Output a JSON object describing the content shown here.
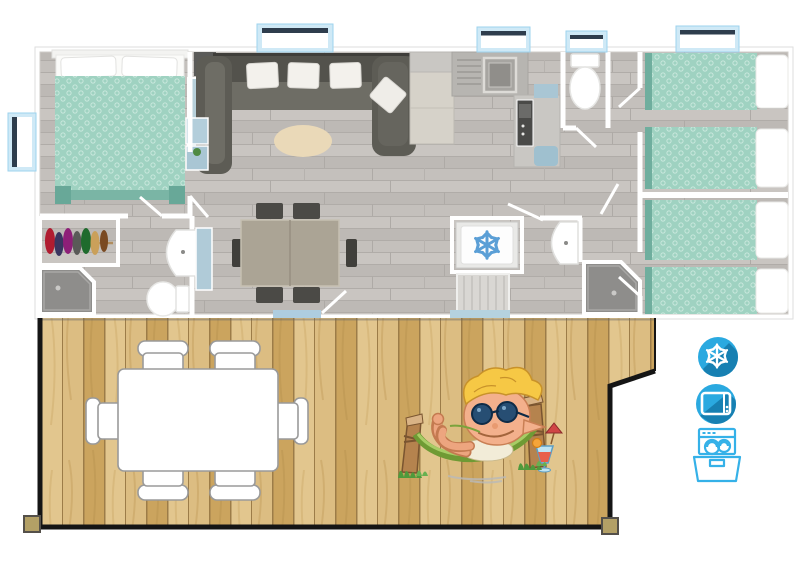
{
  "page": {
    "description": "3D top-down floor plan of a mobile home with a front wooden deck, outdoor table set, mascot illustration and amenity icons",
    "background": "#ffffff"
  },
  "colors": {
    "floor_gray_wood": "#c3bfbb",
    "wall_white": "#ffffff",
    "bedding_teal": "#9fd2c1",
    "bedding_teal_dark": "#6fae9e",
    "sofa_gray": "#55544d",
    "rug_beige": "#ead9b8",
    "window_blue": "#cfe9f6",
    "furniture_blue": "#b0cbd8",
    "deck_wood": "#d5b274",
    "deck_border": "#151515",
    "icon_blue": "#2aa9e0",
    "icon_blue_shadow": "#1780b2",
    "dishwasher_line_blue": "#35b1e8",
    "fridge_snowflake_blue": "#5b9fd6"
  },
  "floorplan": {
    "rooms": [
      "master-bedroom",
      "living-room",
      "dining-area",
      "kitchen",
      "wc",
      "bathroom",
      "hallway",
      "twin-bedroom-1",
      "twin-bedroom-2"
    ],
    "features": [
      "double-bed",
      "wardrobe-closet",
      "hanging-clothes",
      "corner-shower-x2",
      "washbasin-x2",
      "toilet-x2",
      "u-shaped-sofa",
      "oval-rug",
      "dining-table-with-6-chairs",
      "kitchen-sink",
      "oven",
      "fridge-freezer",
      "single-bed-x4",
      "window-x5",
      "entrance-mat-x2"
    ]
  },
  "deck": {
    "furniture": [
      "outdoor-table",
      "outdoor-chair-x6"
    ],
    "mascot": "elf-relaxing-in-hammock-with-cocktail"
  },
  "amenities": {
    "items": [
      {
        "id": "air-conditioning",
        "icon": "snowflake-icon"
      },
      {
        "id": "tv",
        "icon": "tv-icon"
      },
      {
        "id": "dishwasher",
        "icon": "dishwasher-icon"
      }
    ]
  }
}
